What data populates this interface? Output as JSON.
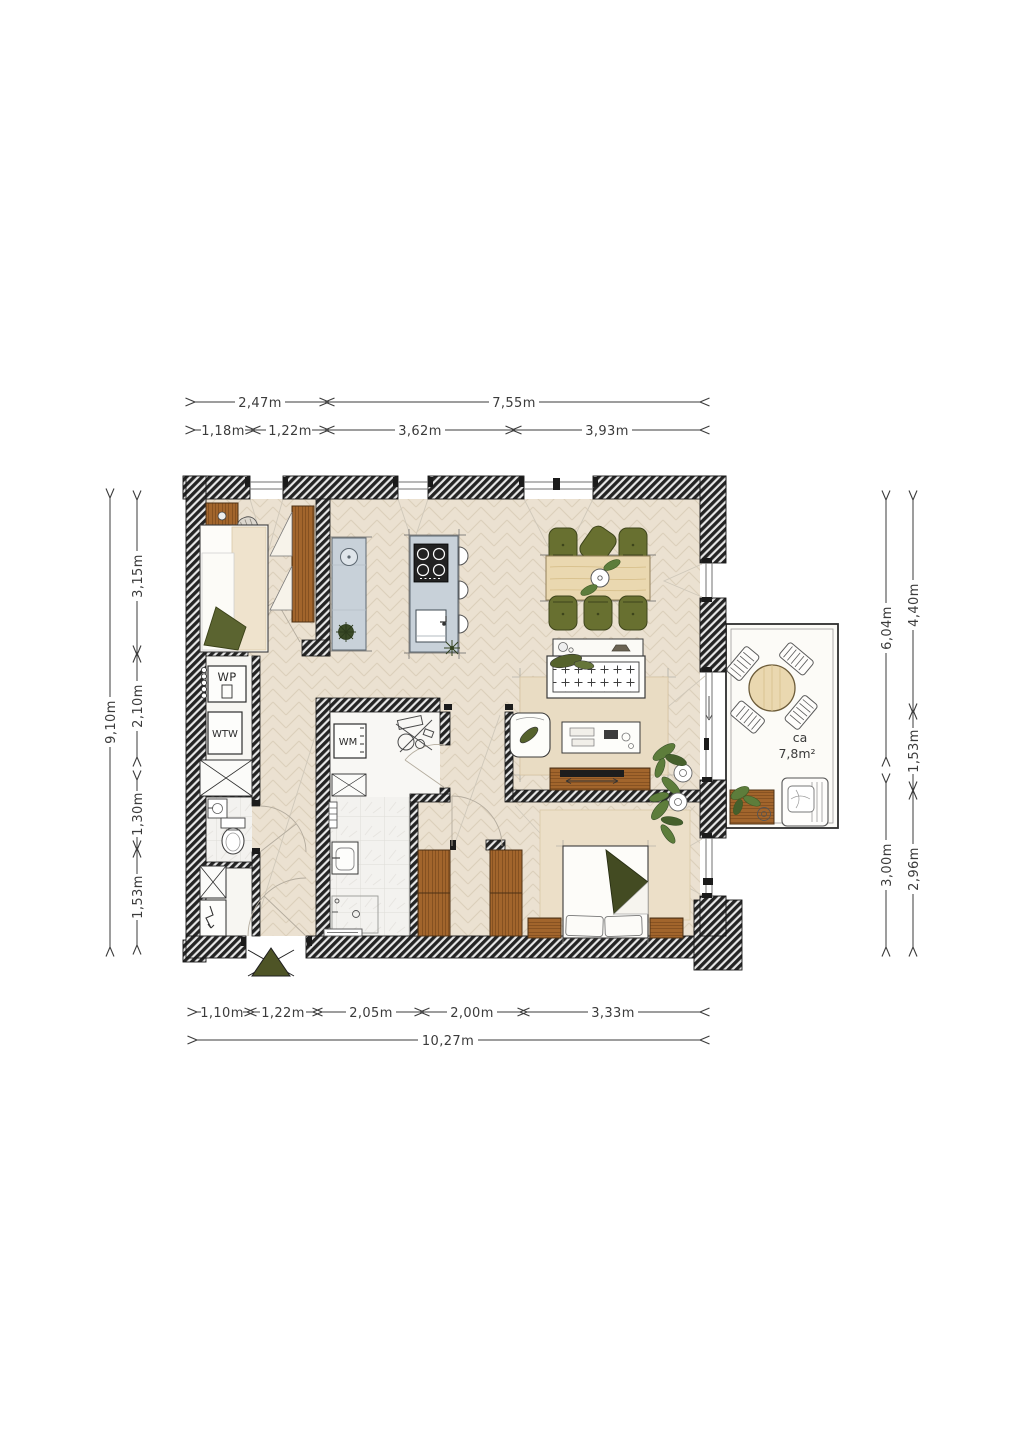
{
  "dimensions": {
    "top_row1": [
      "2,47m",
      "7,55m"
    ],
    "top_row2": [
      "1,18m",
      "1,22m",
      "3,62m",
      "3,93m"
    ],
    "bottom_row1": [
      "1,10m",
      "1,22m",
      "2,05m",
      "2,00m",
      "3,33m"
    ],
    "bottom_total": "10,27m",
    "left_outer": "9,10m",
    "left_inner": [
      "3,15m",
      "2,10m",
      "1,30m",
      "1,53m"
    ],
    "right_outer": [
      "6,04m",
      "3,00m"
    ],
    "right_inner": [
      "4,40m",
      "1,53m",
      "2,96m"
    ]
  },
  "labels": {
    "heat_pump": "WP",
    "heat_recovery_unit": "WTW",
    "washing_machine": "WM",
    "balcony_area_prefix": "ca",
    "balcony_area": "7,8m²"
  },
  "colors": {
    "wall_hatch_dark": "#232323",
    "floor_wood": "#ebe1d1",
    "kitchen_counter": "#c8d1d9",
    "furniture_wood": "#a2652c",
    "light_wood": "#ead8b0",
    "olive_green": "#68702f",
    "plant_green": "#5d7d3b",
    "dimension_text": "#3b3b3b"
  }
}
